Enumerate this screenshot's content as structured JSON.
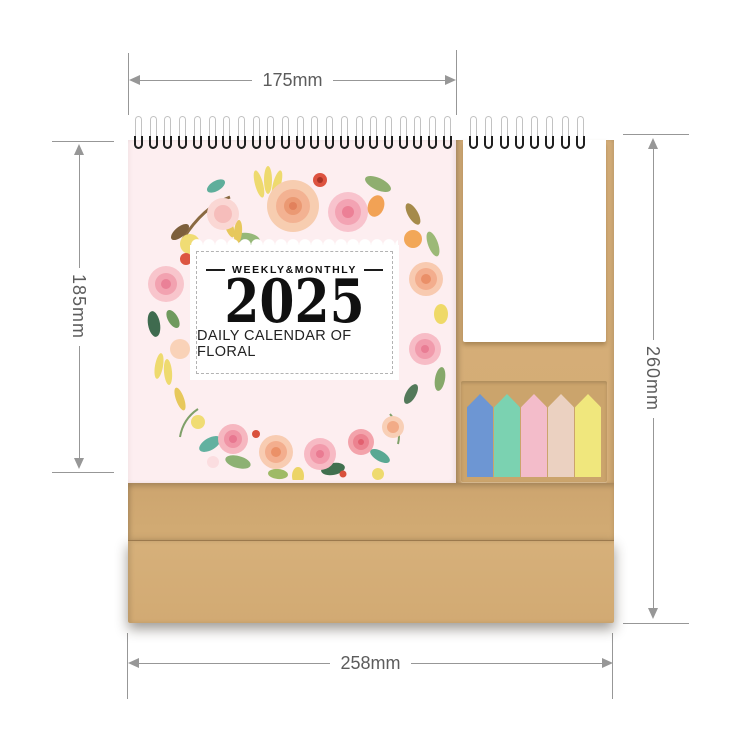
{
  "annotations": {
    "width_top": "175mm",
    "height_left": "185mm",
    "height_right": "260mm",
    "width_bottom": "258mm",
    "line_color": "#979797",
    "text_color": "#5c5c5c"
  },
  "calendar": {
    "cover": {
      "tagline": "WEEKLY&MONTHLY",
      "year": "2025",
      "subtitle": "DAILY CALENDAR OF FLORAL"
    },
    "binding": {
      "left_coil_count": 22,
      "right_coil_count": 8,
      "coil_color": "#1f1f1f",
      "wire_color": "#c2c2c2"
    },
    "sticky_tabs": {
      "colors": [
        "#6d96d3",
        "#7bd2b1",
        "#f3bcca",
        "#ebd1c1",
        "#f0e77d"
      ]
    },
    "colors": {
      "page_pink": "#fdeef0",
      "kraft": "#d3ab74",
      "kraft_light": "#d8b17c",
      "kraft_panel": "#cba46c",
      "notepad_white": "#ffffff"
    }
  }
}
